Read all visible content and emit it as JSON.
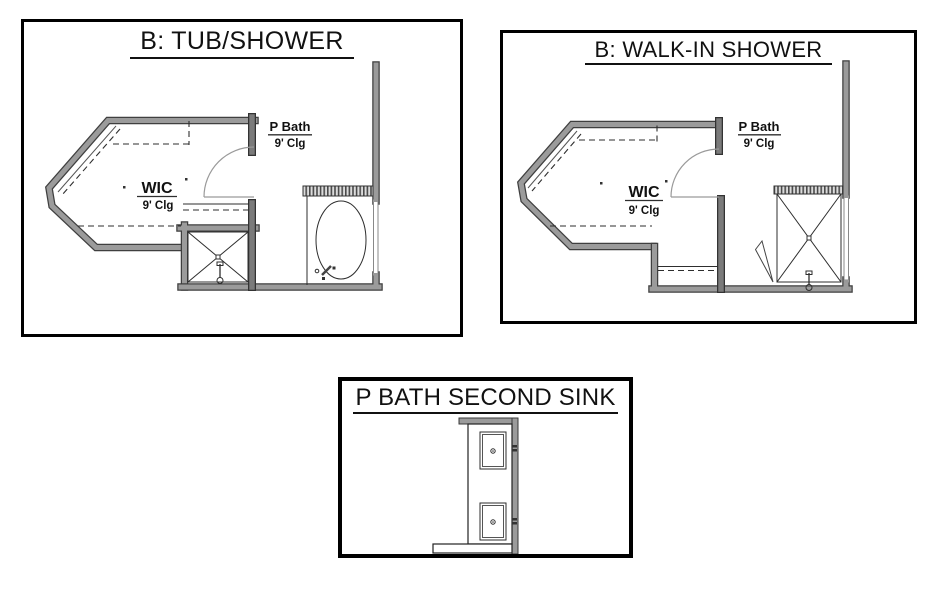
{
  "panels": {
    "tub_shower": {
      "title": "B: TUB/SHOWER",
      "room_labels": {
        "p_bath": {
          "name": "P Bath",
          "ceiling": "9' Clg"
        },
        "wic": {
          "name": "WIC",
          "ceiling": "9' Clg"
        }
      }
    },
    "walk_in_shower": {
      "title": "B: WALK-IN SHOWER",
      "room_labels": {
        "p_bath": {
          "name": "P Bath",
          "ceiling": "9' Clg"
        },
        "wic": {
          "name": "WIC",
          "ceiling": "9' Clg"
        }
      }
    },
    "second_sink": {
      "title": "P BATH SECOND SINK"
    }
  },
  "colors": {
    "background": "#ffffff",
    "panel_border": "#000000",
    "wall_fill": "#9b9b9b",
    "wall_edge": "#3f3f3f",
    "jamb_fill": "#7b7b7b",
    "line": "#2e2e2e",
    "text": "#111111"
  }
}
